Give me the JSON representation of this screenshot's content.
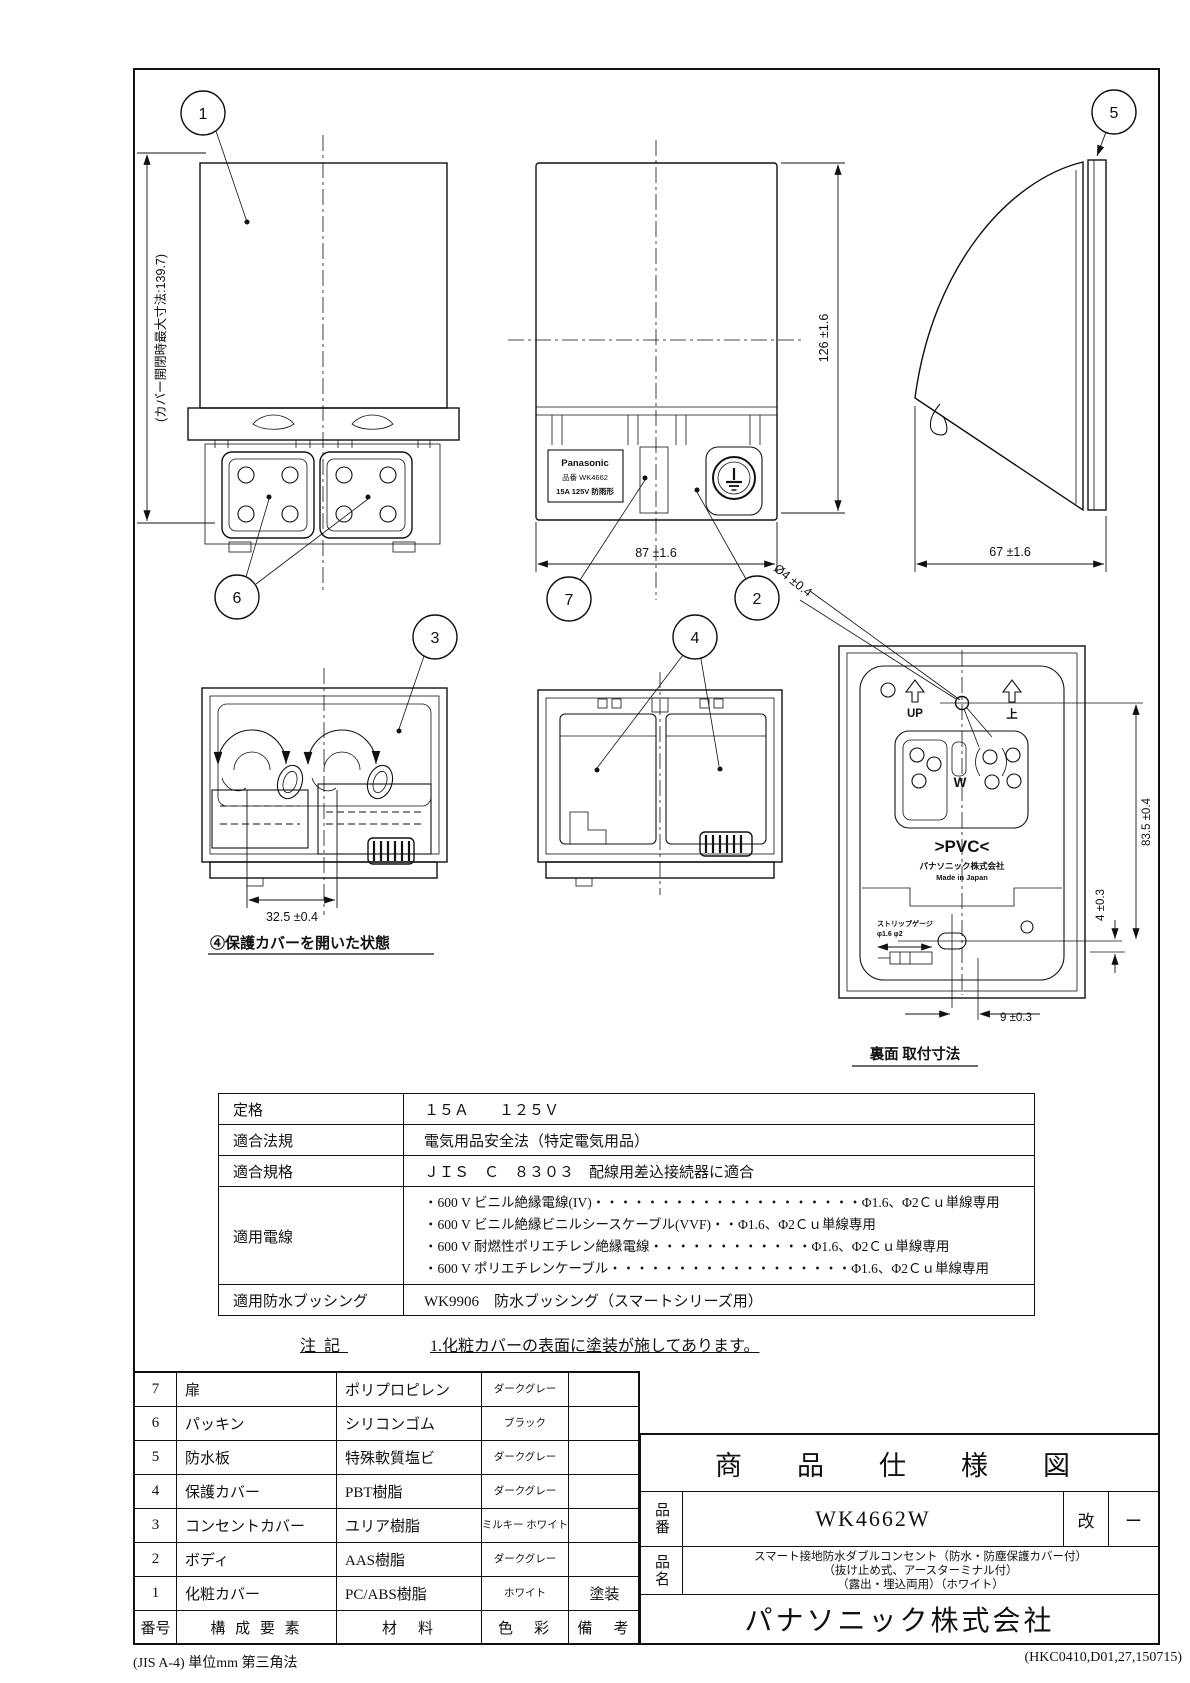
{
  "sheet": {
    "footer_left": "(JIS A-4) 単位mm 第三角法",
    "footer_right": "(HKC0410,D01,27,150715)"
  },
  "callouts": {
    "c1": "1",
    "c2": "2",
    "c3": "3",
    "c4": "4",
    "c5": "5",
    "c6": "6",
    "c7": "7"
  },
  "views": {
    "front_closed": {
      "dim_max_height": "(カバー開閉時最大寸法:139.7)"
    },
    "front_face": {
      "brand": "Panasonic",
      "model_line": "品番 WK4662",
      "rating_line": "15A 125V 防雨形",
      "dim_height": "126 ±1.6",
      "dim_width": "87 ±1.6"
    },
    "side_view": {
      "dim_depth": "67 ±1.6"
    },
    "cover_open": {
      "dim_pitch": "32.5 ±0.4",
      "caption": "④保護カバーを開いた状態"
    },
    "rear_view": {
      "dim_hole": "Ø4 ±0.4",
      "up_label": "UP",
      "up_kanji": "上",
      "terminal_mark": "W",
      "pvc_mark": ">PVC<",
      "maker": "パナソニック株式会社",
      "origin": "Made in Japan",
      "strip_gauge_title": "ストリップゲージ",
      "strip_gauge_value": "φ1.6 φ2",
      "dim_mount_v": "83.5 ±0.4",
      "dim_offset": "4 ±0.3",
      "dim_slot": "9 ±0.3",
      "caption": "裏面 取付寸法"
    }
  },
  "spec_table": {
    "rows": [
      {
        "label": "定格",
        "lines": [
          "１５Ａ　　１２５Ｖ"
        ]
      },
      {
        "label": "適合法規",
        "lines": [
          "電気用品安全法（特定電気用品）"
        ]
      },
      {
        "label": "適合規格",
        "lines": [
          "ＪＩＳ　Ｃ　８３０３　配線用差込接続器に適合"
        ]
      },
      {
        "label": "適用電線",
        "lines": [
          "・600 V ビニル絶縁電線(IV)・・・・・・・・・・・・・・・・・・・・Φ1.6、Φ2Ｃｕ単線専用",
          "・600 V ビニル絶縁ビニルシースケーブル(VVF)・・Φ1.6、Φ2Ｃｕ単線専用",
          "・600 V 耐燃性ポリエチレン絶縁電線・・・・・・・・・・・・Φ1.6、Φ2Ｃｕ単線専用",
          "・600 V ポリエチレンケーブル・・・・・・・・・・・・・・・・・・Φ1.6、Φ2Ｃｕ単線専用"
        ]
      },
      {
        "label": "適用防水ブッシング",
        "lines": [
          "WK9906　防水ブッシング（スマートシリーズ用）"
        ]
      }
    ]
  },
  "note": {
    "label": "注記",
    "text": "1.化粧カバーの表面に塗装が施してあります。"
  },
  "parts_table": {
    "header": {
      "no": "番号",
      "component": "構 成 要 素",
      "material": "材　料",
      "color": "色　彩",
      "remarks": "備　考"
    },
    "rows": [
      {
        "no": "7",
        "component": "扉",
        "material": "ポリプロピレン",
        "color": "ダークグレー",
        "remarks": ""
      },
      {
        "no": "6",
        "component": "パッキン",
        "material": "シリコンゴム",
        "color": "ブラック",
        "remarks": ""
      },
      {
        "no": "5",
        "component": "防水板",
        "material": "特殊軟質塩ビ",
        "color": "ダークグレー",
        "remarks": ""
      },
      {
        "no": "4",
        "component": "保護カバー",
        "material": "PBT樹脂",
        "color": "ダークグレー",
        "remarks": ""
      },
      {
        "no": "3",
        "component": "コンセントカバー",
        "material": "ユリア樹脂",
        "color": "ミルキー ホワイト",
        "remarks": ""
      },
      {
        "no": "2",
        "component": "ボディ",
        "material": "AAS樹脂",
        "color": "ダークグレー",
        "remarks": ""
      },
      {
        "no": "1",
        "component": "化粧カバー",
        "material": "PC/ABS樹脂",
        "color": "ホワイト",
        "remarks": "塗装"
      }
    ]
  },
  "title_block": {
    "title": "商　品　仕　様　図",
    "part_no_label": "品番",
    "part_no": "WK4662W",
    "rev_label": "改",
    "rev_value": "ー",
    "name_label": "品名",
    "name_lines": [
      "スマート接地防水ダブルコンセント（防水・防塵保護カバー付）",
      "（抜け止め式、アースターミナル付）",
      "（露出・埋込両用）（ホワイト）"
    ],
    "company": "パナソニック株式会社"
  }
}
